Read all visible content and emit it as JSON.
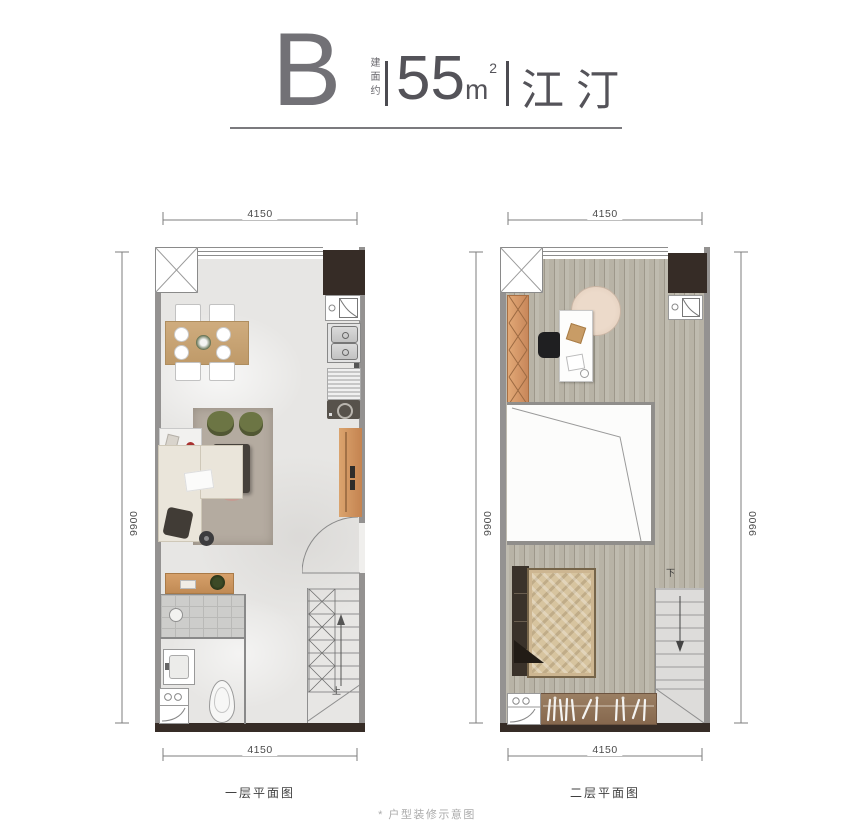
{
  "header": {
    "unit_letter": "B",
    "area_label_vertical": "建面约",
    "area_value": "55",
    "area_unit": "m",
    "area_exponent": "2",
    "unit_name": "江汀"
  },
  "plans": {
    "first": {
      "caption": "一层平面图",
      "dim_top": "4150",
      "dim_bottom": "4150",
      "dim_left": "9900",
      "stair_label": "上"
    },
    "second": {
      "caption": "二层平面图",
      "dim_top": "4150",
      "dim_bottom": "4150",
      "dim_left": "9900",
      "dim_right": "9900",
      "stair_label": "下"
    }
  },
  "footnote": "* 户型装修示意图",
  "colors": {
    "wall_gray": "#949291",
    "dark_wall": "#362c26",
    "wood_accent": "#d49a66",
    "marble_floor": "#e7e6e4",
    "wood_floor": "#b8b3a6",
    "olive_pouf": "#6c7544",
    "text_dark": "#545359",
    "dim_text": "#4b4b4b",
    "footnote_gray": "#ababab"
  }
}
